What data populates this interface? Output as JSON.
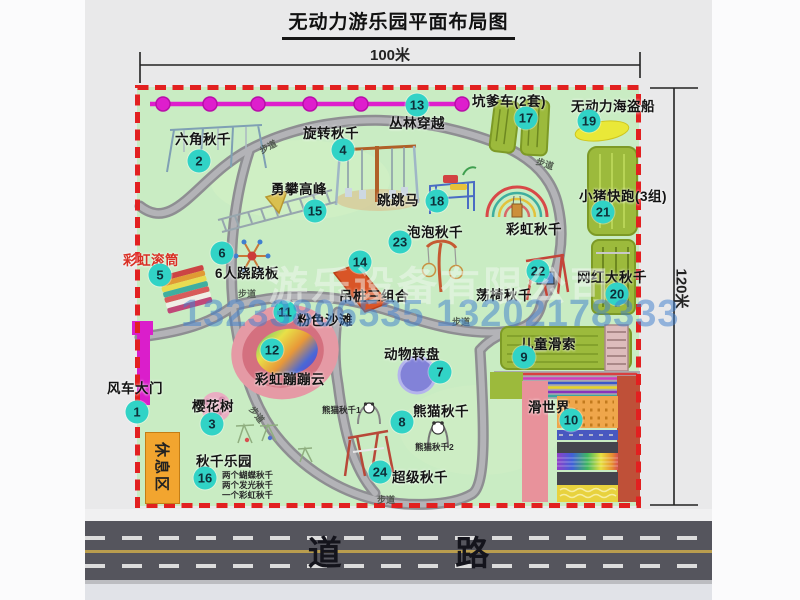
{
  "title": "无动力游乐园平面布局图",
  "dimensions": {
    "width_label": "100米",
    "height_label": "120米"
  },
  "road": {
    "label": "道 路"
  },
  "rest_area": {
    "label": "休息区"
  },
  "walkway_label": "步道",
  "watermark": {
    "company": "游乐设备有限公司",
    "phone": "13233806535 13202178333"
  },
  "legend_colors": {
    "marker_bg": "#31d3c6",
    "map_green": "#c9ecc3",
    "border_red": "#e22020",
    "chain_magenta": "#de1ecd",
    "path_gray": "#98989c",
    "rest_orange": "#f2a52f"
  },
  "attractions": {
    "a1": {
      "num": "1",
      "label": "风车大门"
    },
    "a2": {
      "num": "2",
      "label": "六角秋千"
    },
    "a3": {
      "num": "3",
      "label": "樱花树"
    },
    "a4": {
      "num": "4",
      "label": "旋转秋千"
    },
    "a5": {
      "num": "5",
      "label": "彩虹滚筒"
    },
    "a6": {
      "num": "6",
      "label": "6人跷跷板"
    },
    "a7": {
      "num": "7",
      "label": "动物转盘"
    },
    "a8": {
      "num": "8",
      "label": "熊猫秋千",
      "sub1": "熊猫秋千1",
      "sub2": "熊猫秋千2"
    },
    "a9": {
      "num": "9",
      "label": "儿童滑索"
    },
    "a10": {
      "num": "10",
      "label": "滑世界"
    },
    "a11": {
      "num": "11",
      "label": "粉色沙滩"
    },
    "a12": {
      "num": "12",
      "label": "彩虹蹦蹦云"
    },
    "a13": {
      "num": "13",
      "label": "丛林穿越"
    },
    "a14": {
      "num": "14",
      "label": "吊桩三组合"
    },
    "a15": {
      "num": "15",
      "label": "勇攀高峰"
    },
    "a16": {
      "num": "16",
      "label": "秋千乐园",
      "sub1": "两个蝴蝶秋千",
      "sub2": "两个发光秋千",
      "sub3": "一个彩虹秋千"
    },
    "a17": {
      "num": "17",
      "label": "坑爹车(2套)"
    },
    "a18": {
      "num": "18",
      "label": "跳跳马"
    },
    "a19": {
      "num": "19",
      "label": "无动力海盗船"
    },
    "a20": {
      "num": "20",
      "label": "网红大秋千"
    },
    "a21": {
      "num": "21",
      "label": "小猪快跑(3组)"
    },
    "a22": {
      "num": "22",
      "label": "荡椅秋千"
    },
    "a23": {
      "num": "23",
      "label": "泡泡秋千"
    },
    "a24": {
      "num": "24",
      "label": "超级秋千"
    },
    "rainbow_swing": {
      "label": "彩虹秋千"
    }
  }
}
